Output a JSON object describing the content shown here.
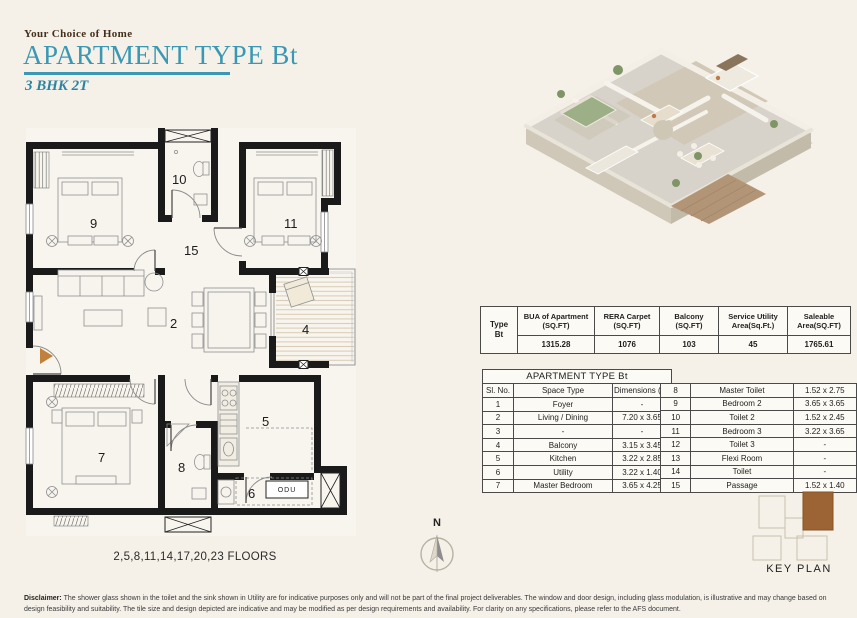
{
  "header": {
    "brand": "Your Choice of Home",
    "title": "APARTMENT TYPE Bt",
    "subtitle": "3 BHK 2T",
    "accent_color": "#3a98b5"
  },
  "area_table": {
    "row_label_line1": "Type",
    "row_label_line2": "Bt",
    "columns": [
      {
        "header": "BUA of Apartment (SQ.FT)",
        "value": "1315.28"
      },
      {
        "header": "RERA Carpet (SQ.FT)",
        "value": "1076"
      },
      {
        "header": "Balcony (SQ.FT)",
        "value": "103"
      },
      {
        "header": "Service Utility Area(Sq.Ft.)",
        "value": "45"
      },
      {
        "header": "Saleable Area(SQ.FT)",
        "value": "1765.61"
      }
    ]
  },
  "space_table": {
    "title": "APARTMENT TYPE Bt",
    "headers": {
      "sl": "Sl. No.",
      "space": "Space Type",
      "dim": "Dimensions (m)"
    },
    "rows_left": [
      {
        "no": "1",
        "space": "Foyer",
        "dim": "-"
      },
      {
        "no": "2",
        "space": "Living / Dining",
        "dim": "7.20 x 3.65"
      },
      {
        "no": "3",
        "space": "-",
        "dim": "-"
      },
      {
        "no": "4",
        "space": "Balcony",
        "dim": "3.15 x 3.45"
      },
      {
        "no": "5",
        "space": "Kitchen",
        "dim": "3.22 x 2.85"
      },
      {
        "no": "6",
        "space": "Utility",
        "dim": "3.22 x 1.40"
      },
      {
        "no": "7",
        "space": "Master Bedroom",
        "dim": "3.65 x 4.25"
      }
    ],
    "rows_right": [
      {
        "no": "8",
        "space": "Master Toilet",
        "dim": "1.52 x 2.75"
      },
      {
        "no": "9",
        "space": "Bedroom 2",
        "dim": "3.65 x 3.65"
      },
      {
        "no": "10",
        "space": "Toilet 2",
        "dim": "1.52 x 2.45"
      },
      {
        "no": "11",
        "space": "Bedroom 3",
        "dim": "3.22 x 3.65"
      },
      {
        "no": "12",
        "space": "Toilet 3",
        "dim": "-"
      },
      {
        "no": "13",
        "space": "Flexi Room",
        "dim": "-"
      },
      {
        "no": "14",
        "space": "Toilet",
        "dim": "-"
      },
      {
        "no": "15",
        "space": "Passage",
        "dim": "1.52 x 1.40"
      }
    ]
  },
  "floorplan": {
    "labels": {
      "living": "2",
      "balcony": "4",
      "kitchen": "5",
      "utility": "6",
      "master_bedroom": "7",
      "master_toilet": "8",
      "bedroom2": "9",
      "toilet2": "10",
      "bedroom3": "11",
      "passage": "15",
      "odu": "ODU"
    },
    "floors_note": "2,5,8,11,14,17,20,23 FLOORS",
    "wall_color": "#1a1a1a",
    "entry_arrow_color": "#c1803b"
  },
  "compass": {
    "north_label": "N"
  },
  "key_plan": {
    "label": "KEY PLAN",
    "highlight_color": "#9c6434"
  },
  "disclaimer": {
    "label": "Disclaimer:",
    "text": " The shower glass shown in the toilet and the sink shown in Utility are for indicative purposes only and will not be part of the final project deliverables. The window and door design, including glass modulation, is illustrative and may change based on design feasibility and suitability. The tile size and design depicted are indicative and may be modified as per design requirements and availability. For clarity on any specifications, please refer to the AFS document."
  }
}
